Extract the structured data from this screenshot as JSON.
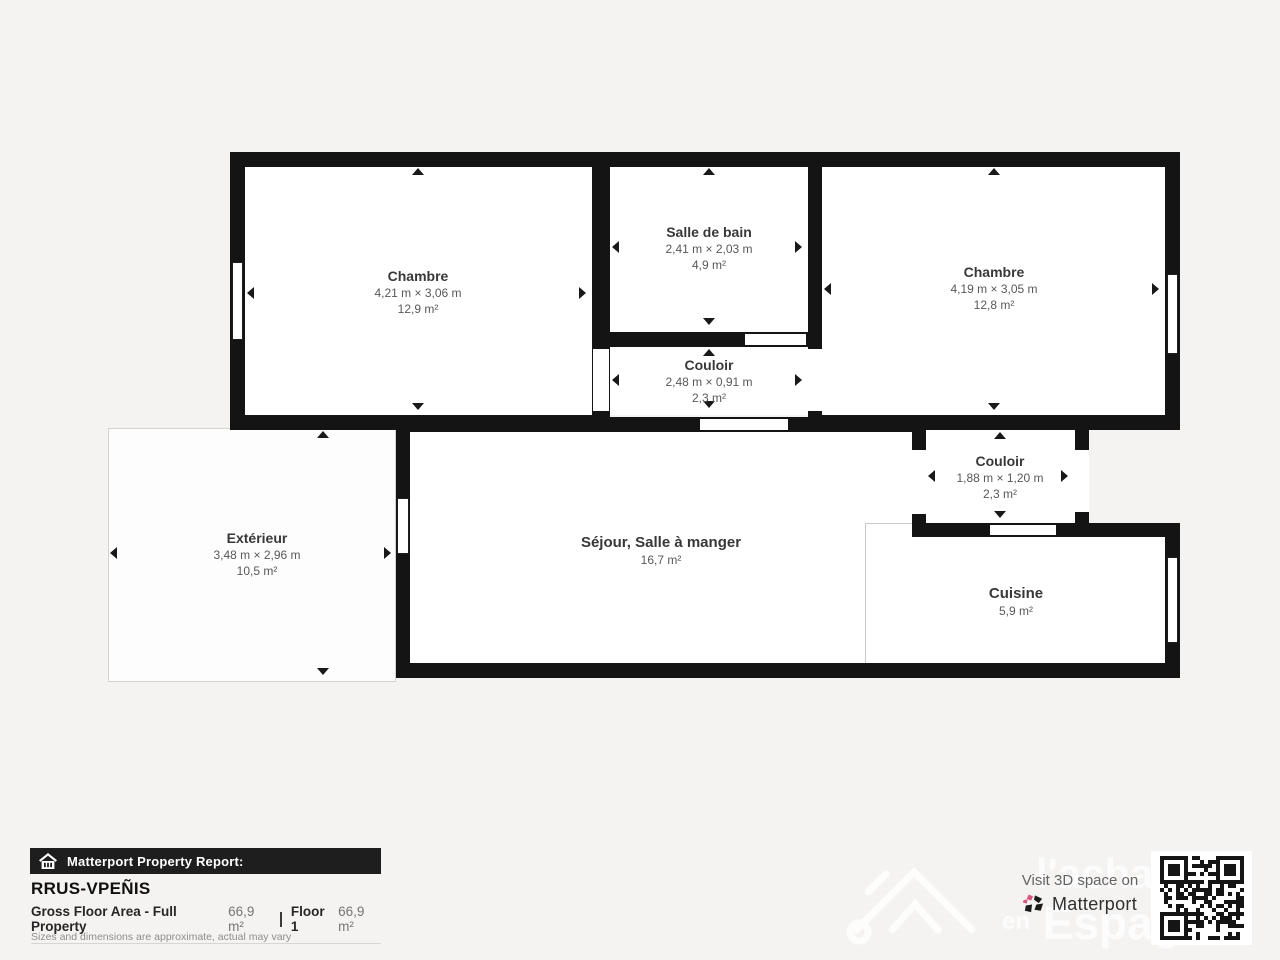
{
  "plan": {
    "rooms": [
      {
        "name": "Chambre",
        "dims": "4,21 m × 3,06 m",
        "area": "12,9 m²"
      },
      {
        "name": "Salle de bain",
        "dims": "2,41 m × 2,03 m",
        "area": "4,9 m²"
      },
      {
        "name": "Couloir",
        "dims": "2,48 m × 0,91 m",
        "area": "2,3 m²"
      },
      {
        "name": "Chambre",
        "dims": "4,19 m × 3,05 m",
        "area": "12,8 m²"
      },
      {
        "name": "Couloir",
        "dims": "1,88 m × 1,20 m",
        "area": "2,3 m²"
      },
      {
        "name": "Extérieur",
        "dims": "3,48 m × 2,96 m",
        "area": "10,5 m²"
      },
      {
        "name": "Séjour, Salle à manger",
        "dims": "",
        "area": "16,7 m²"
      },
      {
        "name": "Cuisine",
        "dims": "",
        "area": "5,9 m²"
      }
    ]
  },
  "report": {
    "banner": "Matterport Property Report:",
    "property_id": "RRUS-VPEÑIS",
    "gfa_label": "Gross Floor Area - Full Property",
    "gfa_value": "66,9 m²",
    "floor_label": "Floor 1",
    "floor_value": "66,9 m²",
    "disclaimer": "Sizes and dimensions are approximate, actual may vary"
  },
  "promo": {
    "visit_text": "Visit 3D space on",
    "brand": "Matterport"
  },
  "watermark": {
    "line1": "l'achat",
    "line2_prefix": "en",
    "line2": "Espagne"
  },
  "icons": {
    "banner_icon": "house-icon",
    "brand_icon": "matterport-pinwheel-icon",
    "qr": "qr-code"
  },
  "colors": {
    "background": "#f4f3f1",
    "wall": "#141414",
    "room_fill": "#ffffff",
    "banner_bg": "#1e1e1e",
    "accent_pink": "#d9537e",
    "text_primary": "#383838",
    "text_secondary": "#585858"
  }
}
